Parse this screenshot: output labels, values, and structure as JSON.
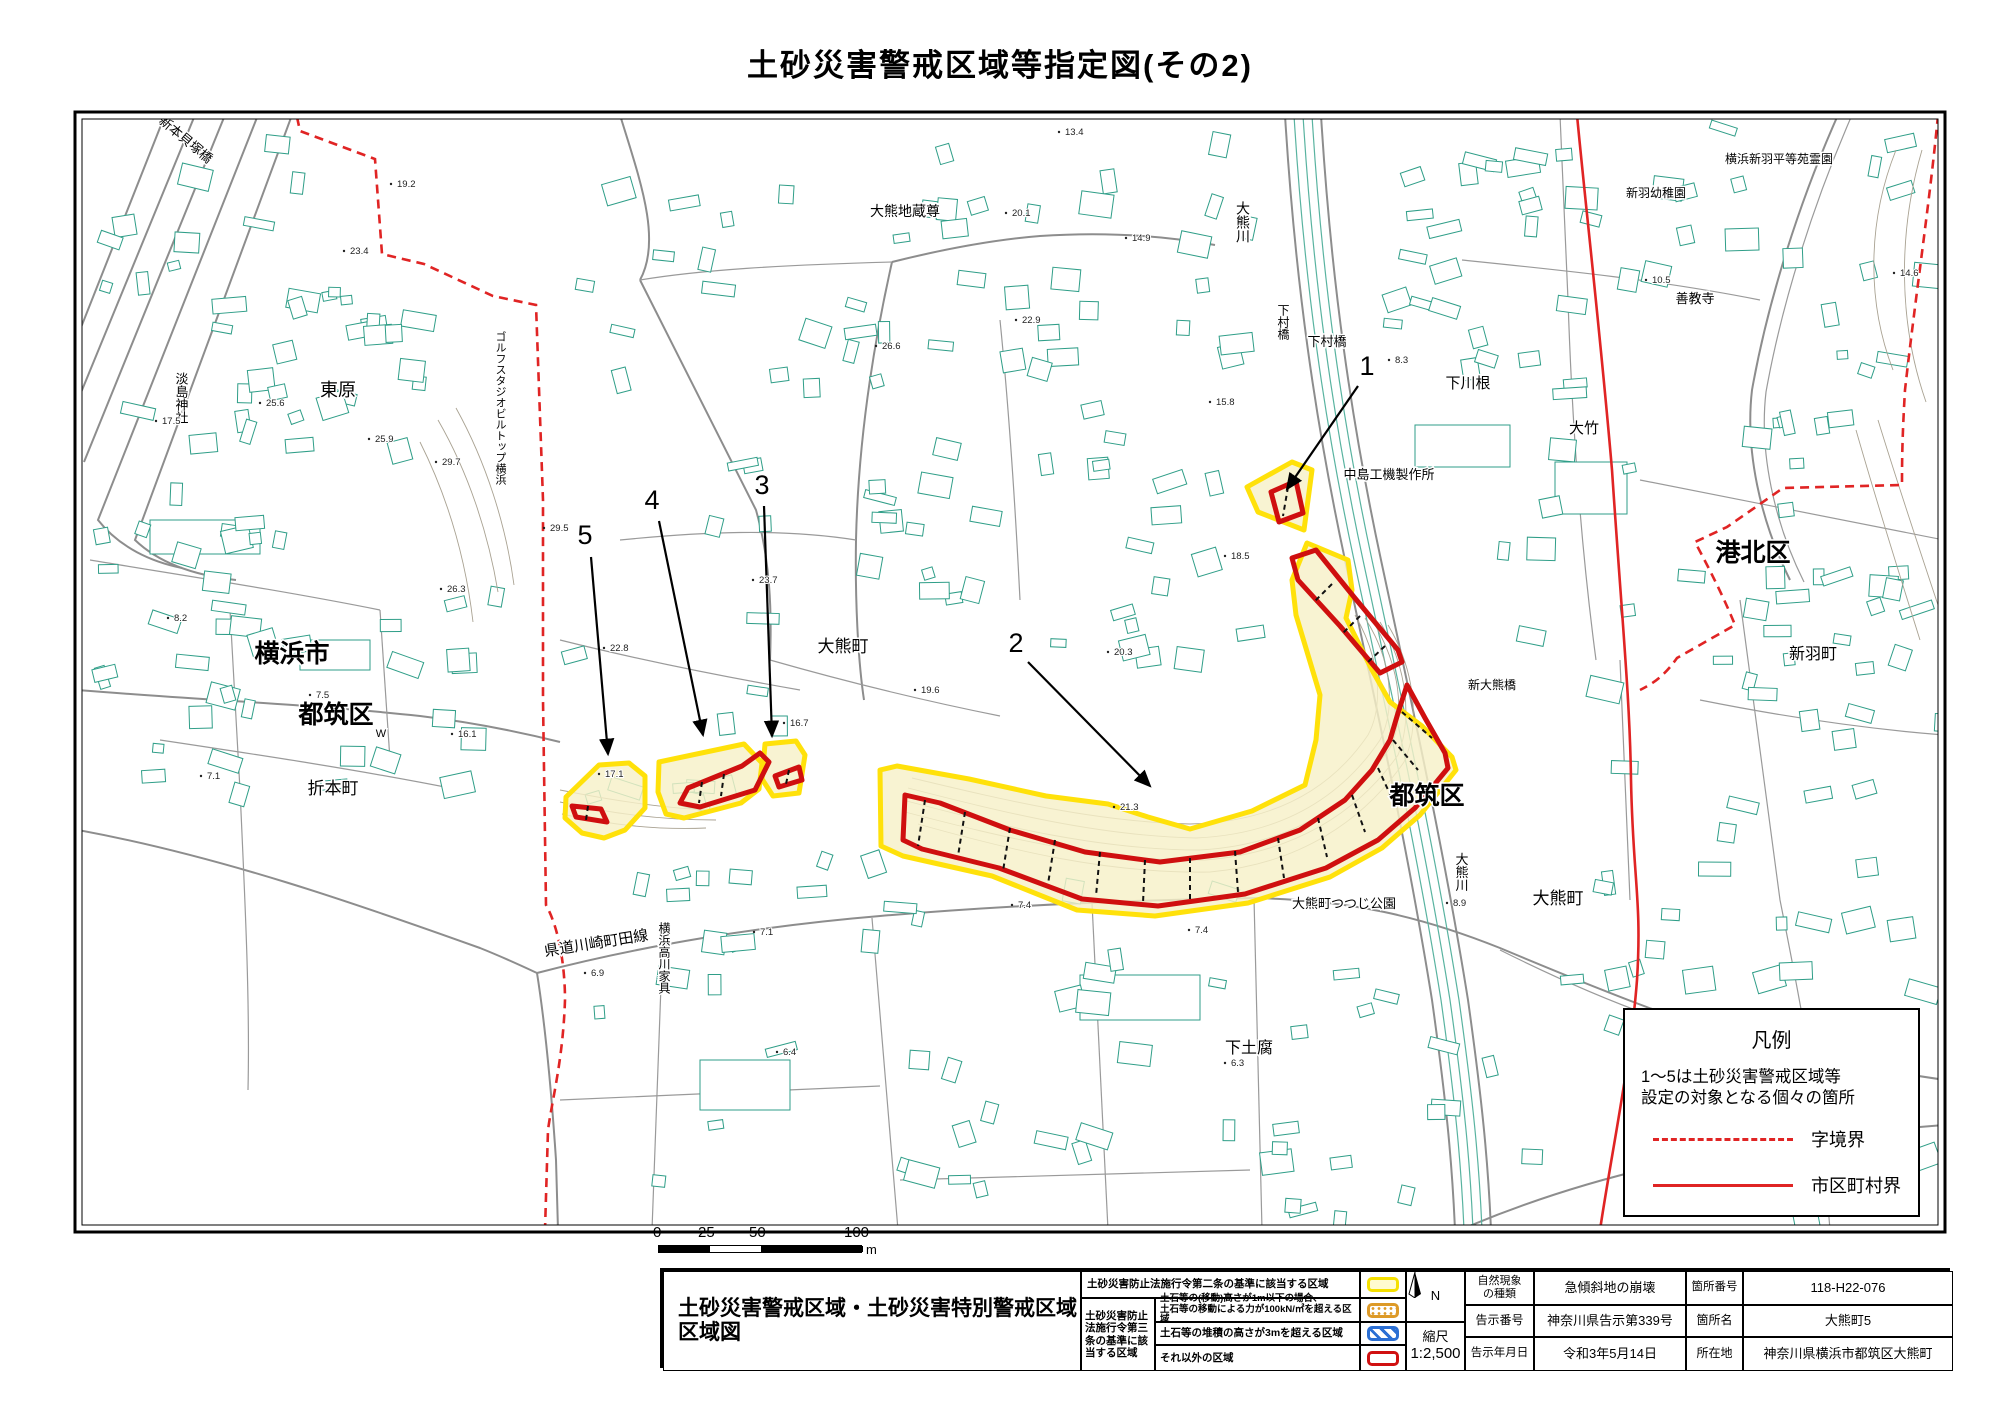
{
  "page": {
    "title": "土砂災害警戒区域等指定図(その2)"
  },
  "colors": {
    "zone_outline_yellow": "#ffe10a",
    "zone_fill_cream": "#f7f0c8",
    "special_zone_red": "#cf0f0f",
    "boundary_red": "#e02424",
    "building_teal": "#2f9e88",
    "road_gray": "#8d8d8d"
  },
  "legend_box": {
    "title": "凡例",
    "note_line1": "1〜5は土砂災害警戒区域等",
    "note_line2": "設定の対象となる個々の箇所",
    "dashed_label": "字境界",
    "solid_label": "市区町村界"
  },
  "scale_bar": {
    "ticks": [
      "0",
      "25",
      "50",
      "100"
    ],
    "unit": "m"
  },
  "info_table": {
    "map_doc_title_line1": "土砂災害警戒区域・土砂災害特別警戒区域",
    "map_doc_title_line2": "区域図",
    "article2_label": "土砂災害防止法施行令第二条の基準に該当する区域",
    "article3_group_label": "土砂災害防止法施行令第三条の基準に該当する区域",
    "article3_rows": {
      "row1_line1": "土石等の(移動)高さが1m以下の場合、",
      "row1_line2": "土石等の移動による力が100kN/㎡を超える区域",
      "row2": "土石等の堆積の高さが3mを超える区域",
      "row3": "それ以外の区域"
    },
    "north_label": "N",
    "scale_label": "縮尺",
    "scale_value": "1:2,500",
    "details": {
      "phenomenon_label": "自然現象\nの種類",
      "phenomenon_value": "急傾斜地の崩壊",
      "site_no_label": "箇所番号",
      "site_no_value": "118-H22-076",
      "notice_no_label": "告示番号",
      "notice_no_value": "神奈川県告示第339号",
      "site_name_label": "箇所名",
      "site_name_value": "大熊町5",
      "notice_date_label": "告示年月日",
      "notice_date_value": "令和3年5月14日",
      "location_label": "所在地",
      "location_value": "神奈川県横浜市都筑区大熊町"
    }
  },
  "map": {
    "labels": [
      {
        "t": "新本貝塚橋",
        "x": 183,
        "y": 143,
        "s": 13,
        "r": 40
      },
      {
        "t": "東原",
        "x": 338,
        "y": 396,
        "s": 18
      },
      {
        "t": "淡島神社",
        "x": 181,
        "y": 398,
        "s": 13,
        "v": 1
      },
      {
        "t": "ゴルフスタジオビルトップ横浜",
        "x": 500,
        "y": 408,
        "s": 11,
        "v": 1
      },
      {
        "t": "横浜市",
        "x": 292,
        "y": 662,
        "s": 25,
        "b": 1
      },
      {
        "t": "都筑区",
        "x": 336,
        "y": 723,
        "s": 25,
        "b": 1
      },
      {
        "t": "折本町",
        "x": 333,
        "y": 794,
        "s": 17
      },
      {
        "t": "県道川崎町田線",
        "x": 597,
        "y": 948,
        "s": 15,
        "r": -9
      },
      {
        "t": "横浜高川家具",
        "x": 664,
        "y": 958,
        "s": 12,
        "v": 1
      },
      {
        "t": "大熊町",
        "x": 843,
        "y": 652,
        "s": 17
      },
      {
        "t": "大熊地蔵尊",
        "x": 905,
        "y": 216,
        "s": 14
      },
      {
        "t": "大熊川",
        "x": 1243,
        "y": 222,
        "s": 14,
        "v": 1
      },
      {
        "t": "下村橋",
        "x": 1283,
        "y": 322,
        "s": 12,
        "v": 1
      },
      {
        "t": "下村橋",
        "x": 1327,
        "y": 346,
        "s": 13
      },
      {
        "t": "中島工機製作所",
        "x": 1389,
        "y": 479,
        "s": 13
      },
      {
        "t": "下川根",
        "x": 1468,
        "y": 388,
        "s": 15
      },
      {
        "t": "大竹",
        "x": 1584,
        "y": 433,
        "s": 15
      },
      {
        "t": "横浜新羽平等苑霊園",
        "x": 1779,
        "y": 163,
        "s": 12
      },
      {
        "t": "新羽幼稚園",
        "x": 1656,
        "y": 197,
        "s": 12
      },
      {
        "t": "善教寺",
        "x": 1695,
        "y": 303,
        "s": 13
      },
      {
        "t": "港北区",
        "x": 1753,
        "y": 561,
        "s": 25,
        "b": 1
      },
      {
        "t": "新羽町",
        "x": 1813,
        "y": 659,
        "s": 16
      },
      {
        "t": "新大熊橋",
        "x": 1492,
        "y": 689,
        "s": 12
      },
      {
        "t": "都筑区",
        "x": 1427,
        "y": 804,
        "s": 25,
        "b": 1
      },
      {
        "t": "大熊町",
        "x": 1558,
        "y": 904,
        "s": 17
      },
      {
        "t": "大熊川",
        "x": 1461,
        "y": 872,
        "s": 13,
        "v": 1
      },
      {
        "t": "大熊町つつじ公園",
        "x": 1344,
        "y": 908,
        "s": 13
      },
      {
        "t": "下土腐",
        "x": 1249,
        "y": 1053,
        "s": 16
      },
      {
        "t": "W",
        "x": 381,
        "y": 737,
        "s": 11
      }
    ],
    "spot_heights": [
      {
        "v": "19.2",
        "x": 397,
        "y": 187
      },
      {
        "v": "17.5",
        "x": 162,
        "y": 424
      },
      {
        "v": "23.4",
        "x": 350,
        "y": 254
      },
      {
        "v": "25.6",
        "x": 266,
        "y": 406
      },
      {
        "v": "25.9",
        "x": 375,
        "y": 442
      },
      {
        "v": "29.7",
        "x": 442,
        "y": 465
      },
      {
        "v": "29.5",
        "x": 550,
        "y": 531
      },
      {
        "v": "26.3",
        "x": 447,
        "y": 592
      },
      {
        "v": "22.8",
        "x": 610,
        "y": 651
      },
      {
        "v": "23.7",
        "x": 759,
        "y": 583
      },
      {
        "v": "16.1",
        "x": 458,
        "y": 737
      },
      {
        "v": "17.1",
        "x": 605,
        "y": 777
      },
      {
        "v": "16.7",
        "x": 790,
        "y": 726
      },
      {
        "v": "20.1",
        "x": 1012,
        "y": 216
      },
      {
        "v": "14.9",
        "x": 1132,
        "y": 241
      },
      {
        "v": "22.9",
        "x": 1022,
        "y": 323
      },
      {
        "v": "26.6",
        "x": 882,
        "y": 349
      },
      {
        "v": "13.4",
        "x": 1065,
        "y": 135
      },
      {
        "v": "10.5",
        "x": 1652,
        "y": 283
      },
      {
        "v": "14.6",
        "x": 1900,
        "y": 276
      },
      {
        "v": "8.2",
        "x": 174,
        "y": 621
      },
      {
        "v": "7.5",
        "x": 316,
        "y": 698
      },
      {
        "v": "7.1",
        "x": 207,
        "y": 779
      },
      {
        "v": "6.9",
        "x": 591,
        "y": 976
      },
      {
        "v": "6.4",
        "x": 783,
        "y": 1055
      },
      {
        "v": "7.1",
        "x": 760,
        "y": 935
      },
      {
        "v": "6.3",
        "x": 1231,
        "y": 1066
      },
      {
        "v": "21.3",
        "x": 1120,
        "y": 810
      },
      {
        "v": "20.3",
        "x": 1114,
        "y": 655
      },
      {
        "v": "19.6",
        "x": 921,
        "y": 693
      },
      {
        "v": "8.9",
        "x": 1453,
        "y": 906
      },
      {
        "v": "7.4",
        "x": 1018,
        "y": 908
      },
      {
        "v": "7.4",
        "x": 1195,
        "y": 933
      },
      {
        "v": "15.8",
        "x": 1216,
        "y": 405
      },
      {
        "v": "18.5",
        "x": 1231,
        "y": 559
      },
      {
        "v": "8.3",
        "x": 1395,
        "y": 363
      }
    ],
    "callouts": [
      {
        "n": "1",
        "lx": 1367,
        "ly": 375,
        "x1": 1358,
        "y1": 386,
        "x2": 1287,
        "y2": 489
      },
      {
        "n": "2",
        "lx": 1016,
        "ly": 652,
        "x1": 1028,
        "y1": 662,
        "x2": 1150,
        "y2": 786
      },
      {
        "n": "3",
        "lx": 762,
        "ly": 494,
        "x1": 764,
        "y1": 506,
        "x2": 772,
        "y2": 736
      },
      {
        "n": "4",
        "lx": 652,
        "ly": 509,
        "x1": 659,
        "y1": 521,
        "x2": 703,
        "y2": 735
      },
      {
        "n": "5",
        "lx": 585,
        "ly": 544,
        "x1": 591,
        "y1": 557,
        "x2": 608,
        "y2": 754
      }
    ]
  }
}
